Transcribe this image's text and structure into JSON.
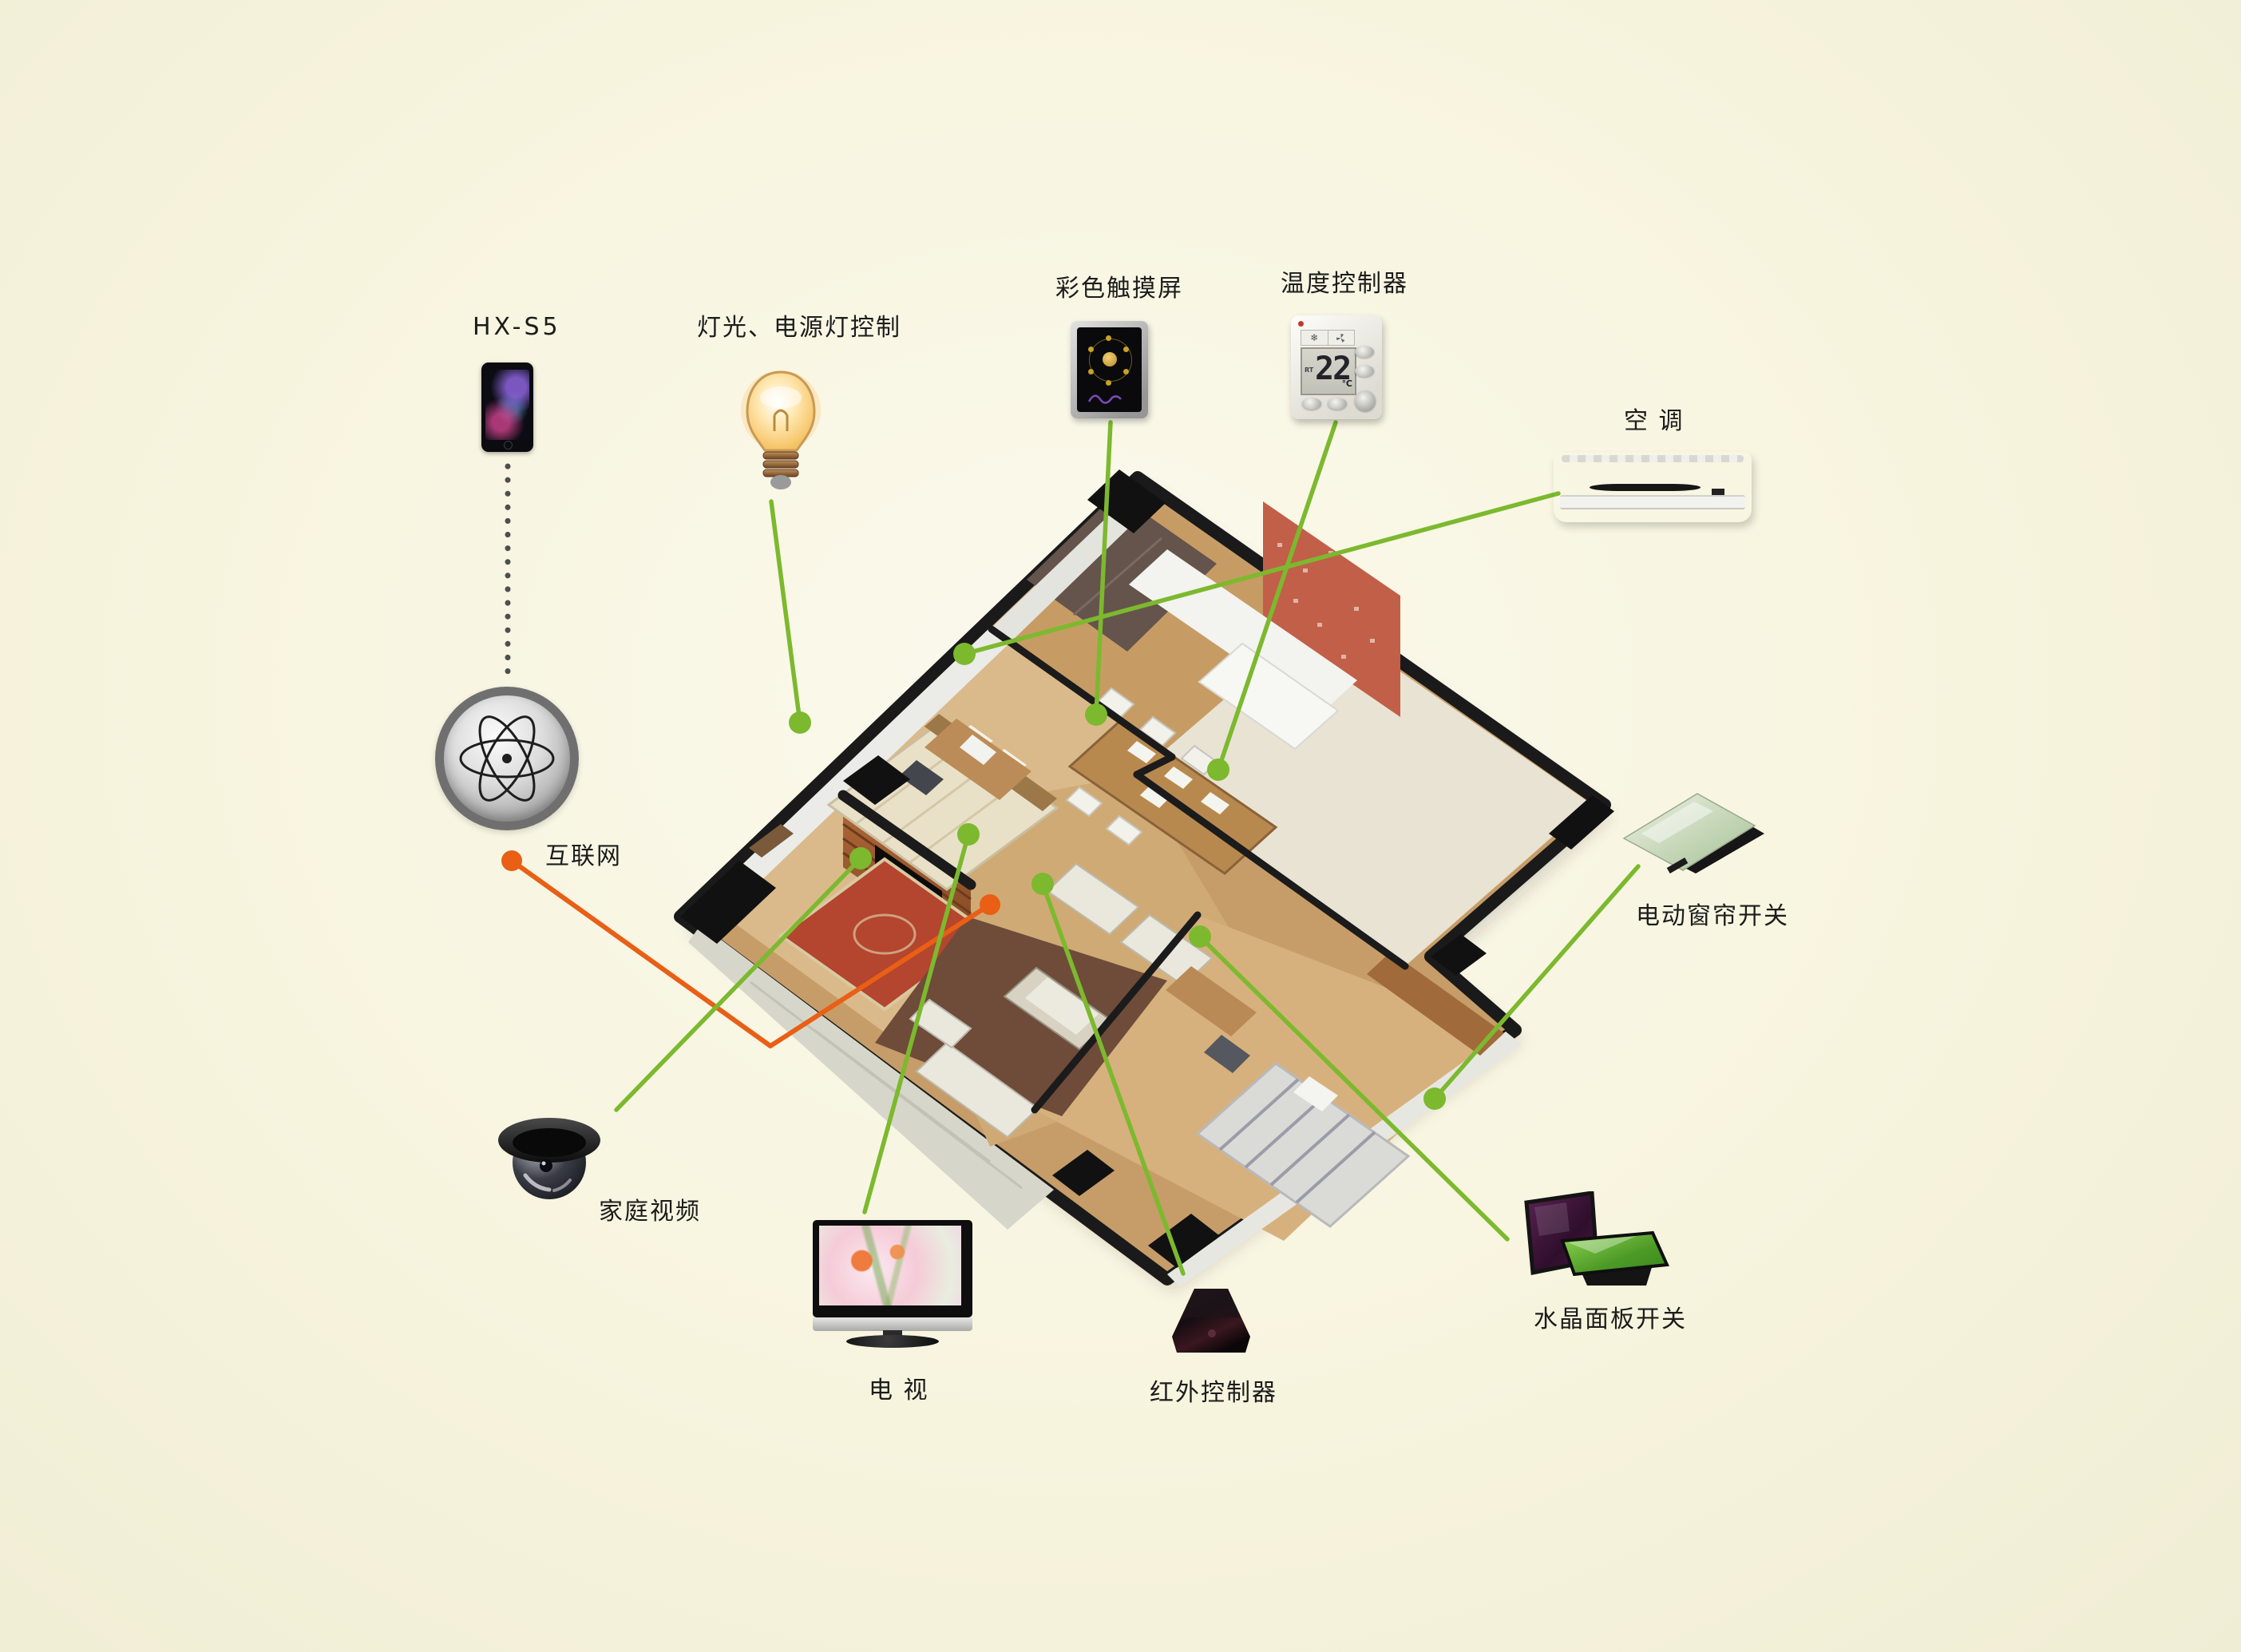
{
  "palette": {
    "background": "#f7f4de",
    "link_green": "#7cb92e",
    "link_orange": "#e85f15",
    "dotted_gray": "#4e4e4e",
    "label_text": "#1c1c1b"
  },
  "devices": {
    "phone": {
      "label": "HX-S5"
    },
    "light": {
      "label": "灯光、电源灯控制"
    },
    "touchscreen": {
      "label": "彩色触摸屏"
    },
    "thermostat": {
      "label": "温度控制器",
      "display_temp": "22",
      "display_unit": "℃",
      "display_mode": "RT",
      "snow_icon": "❄"
    },
    "ac": {
      "label": "空 调"
    },
    "internet": {
      "label": "互联网"
    },
    "camera": {
      "label": "家庭视频"
    },
    "tv": {
      "label": "电 视"
    },
    "ir": {
      "label": "红外控制器"
    },
    "crystal": {
      "label": "水晶面板开关"
    },
    "curtain": {
      "label": "电动窗帘开关"
    }
  },
  "icons": {
    "phone": "smartphone-icon",
    "light": "light-bulb-icon",
    "touchscreen": "touch-panel-icon",
    "thermostat": "thermostat-icon",
    "ac": "air-conditioner-icon",
    "internet": "atom-globe-icon",
    "camera": "dome-camera-icon",
    "tv": "television-icon",
    "ir": "ir-controller-icon",
    "crystal": "crystal-switch-icon",
    "curtain": "curtain-switch-icon"
  },
  "connections": {
    "phone_to_internet": {
      "from": "HX-S5",
      "to": "互联网",
      "style": "dotted-gray"
    },
    "internet_to_home": {
      "from": "互联网",
      "to": "house",
      "style": "orange"
    },
    "green_links": [
      {
        "from": "灯光、电源灯控制",
        "to": "house"
      },
      {
        "from": "彩色触摸屏",
        "to": "house"
      },
      {
        "from": "温度控制器",
        "to": "house"
      },
      {
        "from": "空调",
        "to": "house"
      },
      {
        "from": "家庭视频",
        "to": "house"
      },
      {
        "from": "电视",
        "to": "house"
      },
      {
        "from": "红外控制器",
        "to": "house"
      },
      {
        "from": "水晶面板开关",
        "to": "house"
      },
      {
        "from": "电动窗帘开关",
        "to": "house"
      }
    ]
  }
}
